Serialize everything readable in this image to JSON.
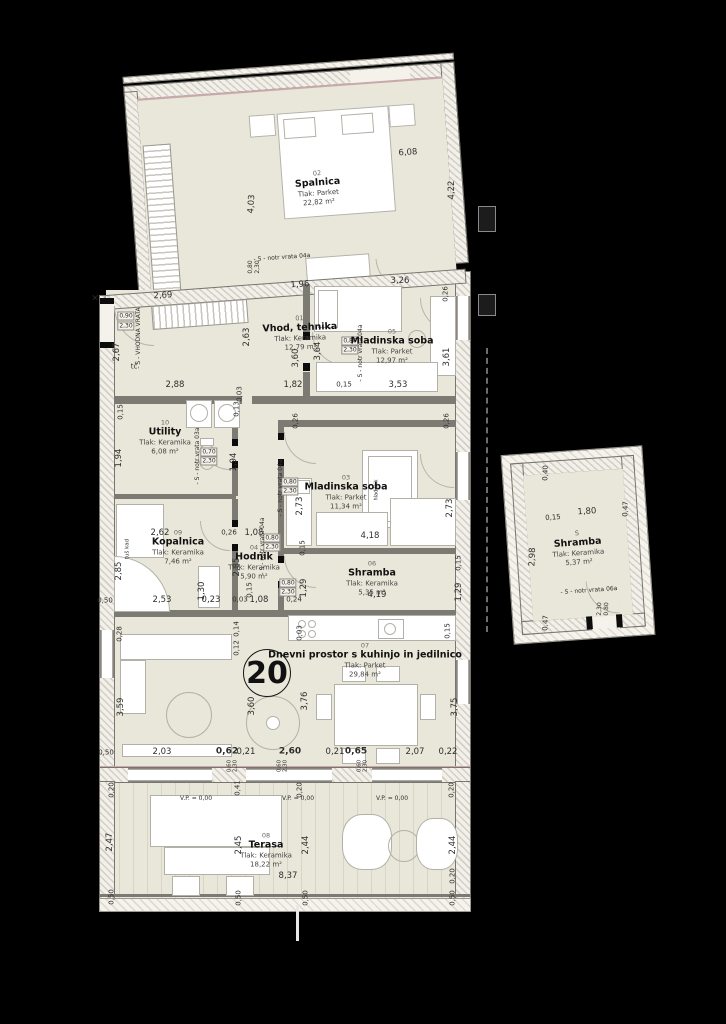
{
  "plan": {
    "apartment_number": "20",
    "background_color": "#000000",
    "floor_color": "#e9e7d9",
    "wall_color": "#7b7a73"
  },
  "rooms": [
    {
      "id": "02",
      "name": "Spalnica",
      "floor": "Tlak: Parket",
      "area": "22,82 m²",
      "x": 318,
      "y": 188,
      "r": -4
    },
    {
      "id": "01",
      "name": "Vhod, tehnika",
      "floor": "Tlak: Keramika",
      "area": "12,79 m²",
      "x": 300,
      "y": 333,
      "r": -2
    },
    {
      "id": "05",
      "name": "Mladinska soba",
      "floor": "Tlak: Parket",
      "area": "12,97 m²",
      "x": 392,
      "y": 346,
      "r": 0
    },
    {
      "id": "10",
      "name": "Utility",
      "floor": "Tlak: Keramika",
      "area": "6,08 m²",
      "x": 165,
      "y": 437,
      "r": 0
    },
    {
      "id": "03",
      "name": "Mladinska soba",
      "floor": "Tlak: Parket",
      "area": "11,34 m²",
      "x": 346,
      "y": 492,
      "r": 0
    },
    {
      "id": "09",
      "name": "Kopalnica",
      "floor": "Tlak: Keramika",
      "area": "7,46 m²",
      "x": 178,
      "y": 547,
      "r": 0
    },
    {
      "id": "04",
      "name": "Hodnik",
      "floor": "Tlak: Keramika",
      "area": "5,90 m²",
      "x": 254,
      "y": 562,
      "r": 0
    },
    {
      "id": "06",
      "name": "Shramba",
      "floor": "Tlak: Keramika",
      "area": "5,35 m²",
      "x": 372,
      "y": 578,
      "r": 0
    },
    {
      "id": "07",
      "name": "Dnevni prostor s kuhinjo in jedilnico",
      "floor": "Tlak: Parket",
      "area": "29,84 m²",
      "x": 365,
      "y": 660,
      "r": 0
    },
    {
      "id": "08",
      "name": "Terasa",
      "floor": "Tlak: Keramika",
      "area": "18,22 m²",
      "x": 266,
      "y": 850,
      "r": 0
    },
    {
      "id": "S",
      "name": "Shramba",
      "floor": "Tlak: Keramika",
      "area": "5,37 m²",
      "x": 578,
      "y": 548,
      "r": -4
    }
  ],
  "labels": [
    {
      "t": "6,08",
      "x": 408,
      "y": 153,
      "r": -4
    },
    {
      "t": "4,03",
      "x": 252,
      "y": 204,
      "r": -86
    },
    {
      "t": "4,22",
      "x": 452,
      "y": 190,
      "r": -90
    },
    {
      "t": "- S - notr vrata 04a",
      "x": 282,
      "y": 258,
      "r": -4,
      "s": 6,
      "k": "door"
    },
    {
      "t": "0,80",
      "x": 251,
      "y": 267,
      "r": -90,
      "s": 6
    },
    {
      "t": "2,30",
      "x": 258,
      "y": 267,
      "r": -90,
      "s": 6
    },
    {
      "t": "2,69",
      "x": 163,
      "y": 296,
      "r": -4
    },
    {
      "t": "1,96",
      "x": 300,
      "y": 285,
      "r": -4
    },
    {
      "t": "3,26",
      "x": 400,
      "y": 281
    },
    {
      "t": "0,26",
      "x": 446,
      "y": 294,
      "r": -90,
      "s": 7
    },
    {
      "t": "0,90",
      "x": 126,
      "y": 316,
      "s": 6,
      "box": true
    },
    {
      "t": "2,30",
      "x": 126,
      "y": 326,
      "s": 6,
      "box": true
    },
    {
      "t": "- S - VHODNA VRATA",
      "x": 139,
      "y": 338,
      "r": -90,
      "s": 6,
      "k": "door"
    },
    {
      "t": "2,67",
      "x": 117,
      "y": 352,
      "r": -90
    },
    {
      "t": "tč",
      "x": 134,
      "y": 367,
      "s": 7
    },
    {
      "t": "×",
      "x": 95,
      "y": 299,
      "s": 9
    },
    {
      "t": "2,63",
      "x": 247,
      "y": 337,
      "r": -90
    },
    {
      "t": "3,60",
      "x": 296,
      "y": 358,
      "r": -90
    },
    {
      "t": "0,80",
      "x": 350,
      "y": 341,
      "s": 6,
      "box": true
    },
    {
      "t": "2,30",
      "x": 350,
      "y": 350,
      "s": 6,
      "box": true
    },
    {
      "t": "- S - notr vrata 04a",
      "x": 361,
      "y": 353,
      "r": -90,
      "s": 6,
      "k": "door"
    },
    {
      "t": "2,88",
      "x": 175,
      "y": 385
    },
    {
      "t": "1,82",
      "x": 293,
      "y": 385
    },
    {
      "t": "0,15",
      "x": 344,
      "y": 385,
      "s": 7
    },
    {
      "t": "3,53",
      "x": 398,
      "y": 385
    },
    {
      "t": "0,03",
      "x": 240,
      "y": 394,
      "r": -90,
      "s": 7
    },
    {
      "t": "3,64",
      "x": 318,
      "y": 351,
      "r": -90
    },
    {
      "t": "3,61",
      "x": 447,
      "y": 357,
      "r": -90
    },
    {
      "t": "0,15",
      "x": 121,
      "y": 412,
      "r": -90,
      "s": 7
    },
    {
      "t": "0,13",
      "x": 237,
      "y": 409,
      "r": -90,
      "s": 7
    },
    {
      "t": "1,94",
      "x": 119,
      "y": 458,
      "r": -90
    },
    {
      "t": "1,94",
      "x": 234,
      "y": 462,
      "r": -90
    },
    {
      "t": "0,70",
      "x": 209,
      "y": 452,
      "s": 6,
      "box": true
    },
    {
      "t": "2,30",
      "x": 209,
      "y": 461,
      "s": 6,
      "box": true
    },
    {
      "t": "- S - notr vrata 03a",
      "x": 198,
      "y": 456,
      "r": -90,
      "s": 6,
      "k": "door"
    },
    {
      "t": "0,26",
      "x": 296,
      "y": 421,
      "r": -90,
      "s": 7
    },
    {
      "t": "0,26",
      "x": 447,
      "y": 421,
      "r": -90,
      "s": 7
    },
    {
      "t": "2,73",
      "x": 300,
      "y": 506,
      "r": -90
    },
    {
      "t": "2,73",
      "x": 450,
      "y": 508,
      "r": -90
    },
    {
      "t": "0,80",
      "x": 290,
      "y": 482,
      "s": 6,
      "box": true
    },
    {
      "t": "2,30",
      "x": 290,
      "y": 491,
      "s": 6,
      "box": true
    },
    {
      "t": "- S - notr vrata 04a",
      "x": 281,
      "y": 488,
      "r": -90,
      "s": 6,
      "k": "door"
    },
    {
      "t": "4,18",
      "x": 370,
      "y": 536
    },
    {
      "t": "0,15",
      "x": 303,
      "y": 548,
      "r": -90,
      "s": 7
    },
    {
      "t": "hladilnik",
      "x": 377,
      "y": 490,
      "r": -90,
      "s": 5
    },
    {
      "t": "2,62",
      "x": 160,
      "y": 533
    },
    {
      "t": "0,26",
      "x": 229,
      "y": 533,
      "s": 7
    },
    {
      "t": "1,08",
      "x": 254,
      "y": 533
    },
    {
      "t": "0,80",
      "x": 272,
      "y": 538,
      "s": 6,
      "box": true
    },
    {
      "t": "2,30",
      "x": 272,
      "y": 547,
      "s": 6,
      "box": true
    },
    {
      "t": "- S - notr vrata 04a",
      "x": 263,
      "y": 546,
      "r": -90,
      "s": 6,
      "k": "door"
    },
    {
      "t": "2,85",
      "x": 119,
      "y": 571,
      "r": -90
    },
    {
      "t": "2,85",
      "x": 237,
      "y": 567,
      "r": -90
    },
    {
      "t": "1,30",
      "x": 202,
      "y": 591,
      "r": -90
    },
    {
      "t": "2,53",
      "x": 162,
      "y": 600
    },
    {
      "t": "0,23",
      "x": 211,
      "y": 600
    },
    {
      "t": "tuš kad",
      "x": 128,
      "y": 549,
      "r": -90,
      "s": 5.5
    },
    {
      "t": "0,50",
      "x": 105,
      "y": 601,
      "s": 7
    },
    {
      "t": "0,03",
      "x": 240,
      "y": 600,
      "s": 7
    },
    {
      "t": "1,08",
      "x": 259,
      "y": 600
    },
    {
      "t": "0,24",
      "x": 294,
      "y": 600,
      "s": 7
    },
    {
      "t": "0,80",
      "x": 288,
      "y": 583,
      "s": 6,
      "box": true
    },
    {
      "t": "2,30",
      "x": 288,
      "y": 592,
      "s": 6,
      "box": true
    },
    {
      "t": "1,29",
      "x": 304,
      "y": 588,
      "r": -90
    },
    {
      "t": "0,15",
      "x": 250,
      "y": 590,
      "r": -90,
      "s": 7
    },
    {
      "t": "0,14",
      "x": 237,
      "y": 629,
      "r": -90,
      "s": 7
    },
    {
      "t": "0,12",
      "x": 237,
      "y": 648,
      "r": -90,
      "s": 7
    },
    {
      "t": "0,28",
      "x": 120,
      "y": 634,
      "r": -90,
      "s": 7
    },
    {
      "t": "4,19",
      "x": 377,
      "y": 595
    },
    {
      "t": "1,29",
      "x": 459,
      "y": 592,
      "r": -90
    },
    {
      "t": "0,15",
      "x": 459,
      "y": 563,
      "r": -90,
      "s": 7
    },
    {
      "t": "0,03",
      "x": 300,
      "y": 633,
      "r": -90,
      "s": 7
    },
    {
      "t": "0,15",
      "x": 448,
      "y": 631,
      "r": -90,
      "s": 7
    },
    {
      "t": "3,59",
      "x": 121,
      "y": 707,
      "r": -90
    },
    {
      "t": "3,60",
      "x": 252,
      "y": 706,
      "r": -90
    },
    {
      "t": "3,76",
      "x": 305,
      "y": 701,
      "r": -90
    },
    {
      "t": "3,75",
      "x": 455,
      "y": 707,
      "r": -90
    },
    {
      "t": "0,50",
      "x": 106,
      "y": 753,
      "s": 7
    },
    {
      "t": "2,03",
      "x": 162,
      "y": 752
    },
    {
      "t": "0,62",
      "x": 227,
      "y": 752,
      "b": true
    },
    {
      "t": "0,21",
      "x": 246,
      "y": 752
    },
    {
      "t": "2,60",
      "x": 290,
      "y": 752,
      "b": true
    },
    {
      "t": "0,21",
      "x": 335,
      "y": 752
    },
    {
      "t": "0,65",
      "x": 356,
      "y": 752,
      "b": true
    },
    {
      "t": "2,07",
      "x": 415,
      "y": 752
    },
    {
      "t": "0,22",
      "x": 448,
      "y": 752
    },
    {
      "t": "0,60",
      "x": 230,
      "y": 766,
      "r": -90,
      "s": 5.5
    },
    {
      "t": "2,30",
      "x": 236,
      "y": 766,
      "r": -90,
      "s": 5.5
    },
    {
      "t": "0,60",
      "x": 280,
      "y": 766,
      "r": -90,
      "s": 5.5
    },
    {
      "t": "2,30",
      "x": 286,
      "y": 766,
      "r": -90,
      "s": 5.5
    },
    {
      "t": "0,60",
      "x": 360,
      "y": 766,
      "r": -90,
      "s": 5.5
    },
    {
      "t": "2,30",
      "x": 366,
      "y": 766,
      "r": -90,
      "s": 5.5
    },
    {
      "t": "0,20",
      "x": 112,
      "y": 790,
      "r": -90,
      "s": 7
    },
    {
      "t": "0,41",
      "x": 238,
      "y": 788,
      "r": -90,
      "s": 7
    },
    {
      "t": "0,20",
      "x": 300,
      "y": 790,
      "r": -90,
      "s": 7
    },
    {
      "t": "0,20",
      "x": 452,
      "y": 790,
      "r": -90,
      "s": 7
    },
    {
      "t": "V.P. = 0,00",
      "x": 196,
      "y": 799,
      "s": 6,
      "k": "level"
    },
    {
      "t": "V.P. = 0,00",
      "x": 298,
      "y": 799,
      "s": 6,
      "k": "level"
    },
    {
      "t": "V.P. = 0,00",
      "x": 392,
      "y": 799,
      "s": 6,
      "k": "level"
    },
    {
      "t": "2,47",
      "x": 110,
      "y": 842,
      "r": -90
    },
    {
      "t": "2,45",
      "x": 239,
      "y": 845,
      "r": -90
    },
    {
      "t": "2,44",
      "x": 306,
      "y": 845,
      "r": -90
    },
    {
      "t": "2,44",
      "x": 453,
      "y": 845,
      "r": -90
    },
    {
      "t": "8,37",
      "x": 288,
      "y": 876
    },
    {
      "t": "0,20",
      "x": 453,
      "y": 876,
      "r": -90,
      "s": 7
    },
    {
      "t": "0,50",
      "x": 112,
      "y": 897,
      "r": -90,
      "s": 7
    },
    {
      "t": "0,50",
      "x": 239,
      "y": 898,
      "r": -90,
      "s": 7
    },
    {
      "t": "0,50",
      "x": 306,
      "y": 898,
      "r": -90,
      "s": 7
    },
    {
      "t": "0,50",
      "x": 453,
      "y": 898,
      "r": -90,
      "s": 7
    },
    {
      "t": "0,40",
      "x": 546,
      "y": 473,
      "r": -88,
      "s": 7
    },
    {
      "t": "0,15",
      "x": 553,
      "y": 518,
      "r": -4,
      "s": 7
    },
    {
      "t": "1,80",
      "x": 587,
      "y": 512,
      "r": -4
    },
    {
      "t": "0,47",
      "x": 626,
      "y": 509,
      "r": -88,
      "s": 7
    },
    {
      "t": "2,98",
      "x": 533,
      "y": 557,
      "r": -88
    },
    {
      "t": "- S - notr vrata 06a",
      "x": 589,
      "y": 591,
      "r": -4,
      "s": 6,
      "k": "door"
    },
    {
      "t": "0,80",
      "x": 607,
      "y": 609,
      "r": -88,
      "s": 6
    },
    {
      "t": "2,30",
      "x": 600,
      "y": 609,
      "r": -88,
      "s": 6
    },
    {
      "t": "0,47",
      "x": 546,
      "y": 623,
      "r": -88,
      "s": 7
    }
  ]
}
